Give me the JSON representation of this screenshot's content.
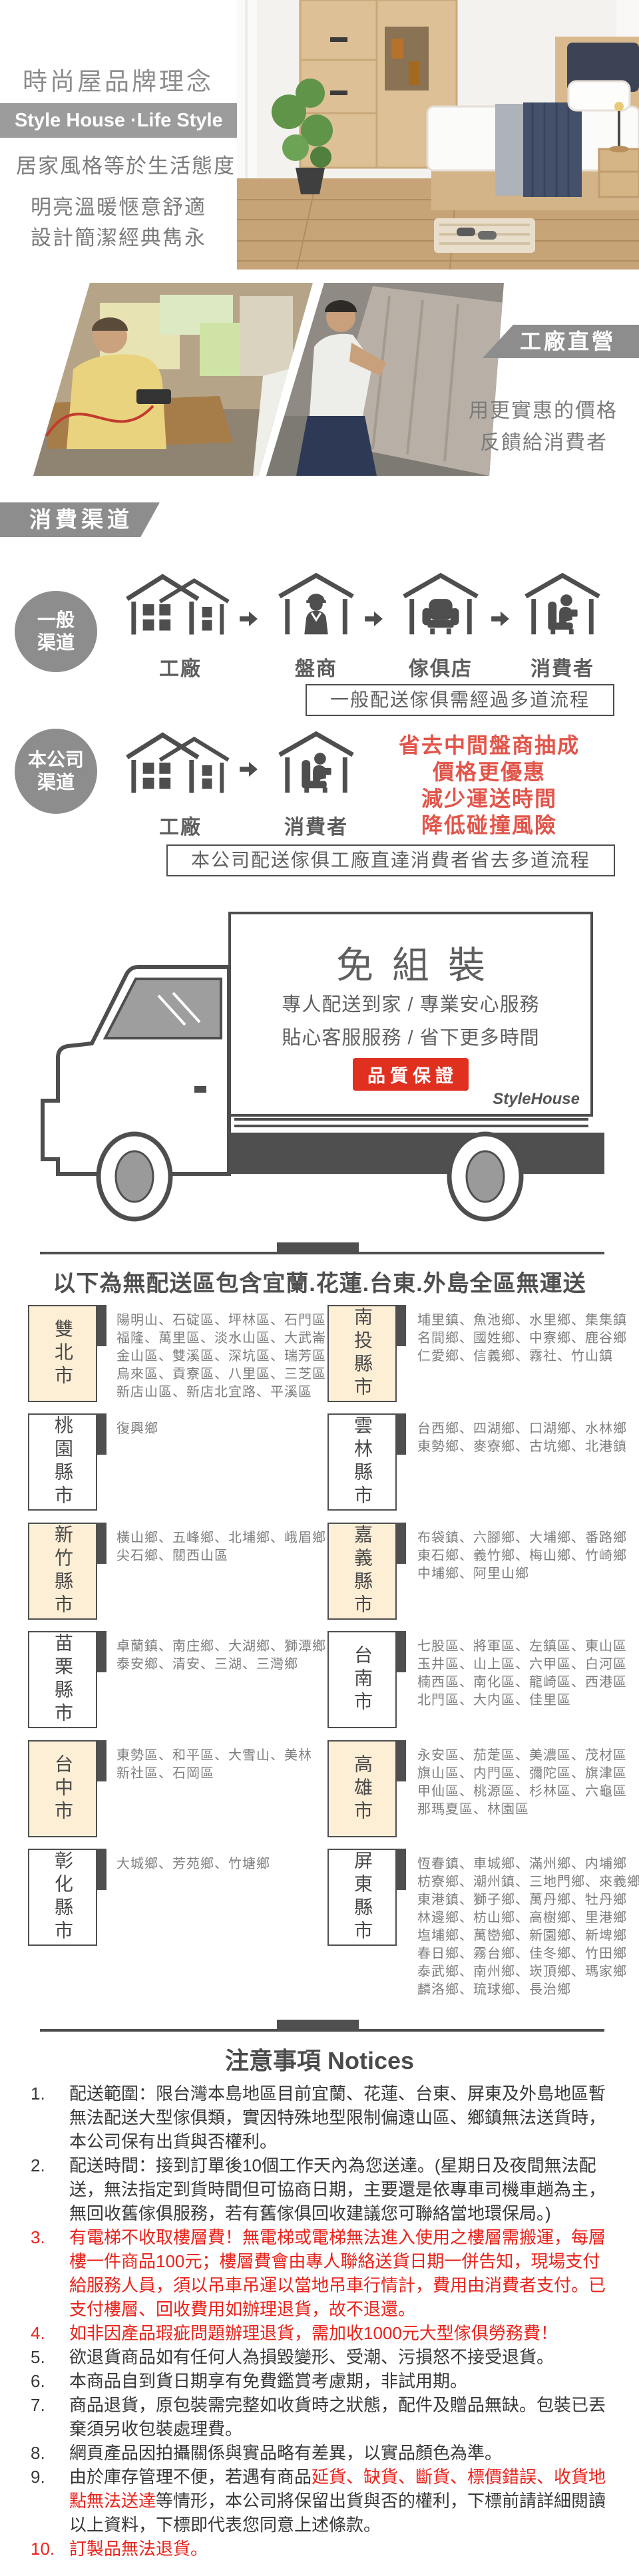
{
  "colors": {
    "banner_gray": "#9c9c9c",
    "mid_gray": "#8d8d8d",
    "outline": "#4e4e4e",
    "beige": "#fdeed6",
    "benefit_red": "#e2554a",
    "notice_red": "#e8231b",
    "badge_red": "#e03020"
  },
  "brand": {
    "title": "時尚屋品牌理念",
    "banner": "Style House ·Life Style",
    "lines": [
      "居家風格等於生活態度",
      "明亮溫暖愜意舒適",
      "設計簡潔經典雋永"
    ]
  },
  "factory": {
    "banner": "工廠直營",
    "lines": [
      "用更實惠的價格",
      "反饋給消費者"
    ]
  },
  "channels": {
    "banner": "消費渠道",
    "general": {
      "badge_lines": [
        "一般",
        "渠道"
      ],
      "steps": [
        "工廠",
        "盤商",
        "傢俱店",
        "消費者"
      ],
      "note": "一般配送傢俱需經過多道流程"
    },
    "company": {
      "badge_lines": [
        "本公司",
        "渠道"
      ],
      "steps": [
        "工廠",
        "消費者"
      ],
      "benefits": [
        "省去中間盤商抽成",
        "價格更優惠",
        "減少運送時間",
        "降低碰撞風險"
      ],
      "note": "本公司配送傢俱工廠直達消費者省去多道流程"
    }
  },
  "truck": {
    "headline": "免組裝",
    "lines": [
      "專人配送到家 / 專業安心服務",
      "貼心客服服務 / 省下更多時間"
    ],
    "badge": "品質保證",
    "brand": "StyleHouse"
  },
  "no_delivery": {
    "title": "以下為無配送區包含宜蘭.花蓮.台東.外島全區無運送",
    "rows": [
      {
        "left": {
          "name": "雙北市",
          "beige": true,
          "lines": [
            "陽明山、石碇區、坪林區、石門區",
            "福隆、萬里區、淡水山區、大武崙",
            "金山區、雙溪區、深坑區、瑞芳區",
            "烏來區、貢寮區、八里區、三芝區",
            "新店山區、新店北宜路、平溪區"
          ]
        },
        "right": {
          "name": "南投縣市",
          "beige": true,
          "lines": [
            "埔里鎮、魚池鄉、水里鄉、集集鎮",
            "名間鄉、國姓鄉、中寮鄉、鹿谷鄉",
            "仁愛鄉、信義鄉、霧社、竹山鎮"
          ]
        }
      },
      {
        "left": {
          "name": "桃園縣市",
          "beige": false,
          "lines": [
            "復興鄉"
          ]
        },
        "right": {
          "name": "雲林縣市",
          "beige": false,
          "lines": [
            "台西鄉、四湖鄉、口湖鄉、水林鄉",
            "東勢鄉、麥寮鄉、古坑鄉、北港鎮"
          ]
        }
      },
      {
        "left": {
          "name": "新竹縣市",
          "beige": true,
          "lines": [
            "橫山鄉、五峰鄉、北埔鄉、峨眉鄉",
            "尖石鄉、關西山區"
          ]
        },
        "right": {
          "name": "嘉義縣市",
          "beige": true,
          "lines": [
            "布袋鎮、六腳鄉、大埔鄉、番路鄉",
            "東石鄉、義竹鄉、梅山鄉、竹崎鄉",
            "中埔鄉、阿里山鄉"
          ]
        }
      },
      {
        "left": {
          "name": "苗栗縣市",
          "beige": false,
          "lines": [
            "卓蘭鎮、南庄鄉、大湖鄉、獅潭鄉",
            "泰安鄉、清安、三湖、三灣鄉"
          ]
        },
        "right": {
          "name": "台南市",
          "beige": false,
          "lines": [
            "七股區、將軍區、左鎮區、東山區",
            "玉井區、山上區、六甲區、白河區",
            "楠西區、南化區、龍崎區、西港區",
            "北門區、大内區、佳里區"
          ]
        }
      },
      {
        "left": {
          "name": "台中市",
          "beige": true,
          "lines": [
            "東勢區、和平區、大雪山、美林",
            "新社區、石岡區"
          ]
        },
        "right": {
          "name": "高雄市",
          "beige": true,
          "lines": [
            "永安區、茄萣區、美濃區、茂材區",
            "旗山區、内門區、彌陀區、旗津區",
            "甲仙區、桃源區、杉林區、六龜區",
            "那瑪夏區、林園區"
          ]
        }
      },
      {
        "left": {
          "name": "彰化縣市",
          "beige": false,
          "lines": [
            "大城鄉、芳苑鄉、竹塘鄉"
          ]
        },
        "right": {
          "name": "屏東縣市",
          "beige": false,
          "lines": [
            "恆春鎮、車城鄉、滿州鄉、内埔鄉",
            "枋寮鄉、潮州鎮、三地門鄉、來義鄉",
            "東港鎮、獅子鄉、萬丹鄉、牡丹鄉",
            "林邊鄉、枋山鄉、高樹鄉、里港鄉",
            "塩埔鄉、萬巒鄉、新園鄉、新埤鄉",
            "春日鄉、霧台鄉、佳冬鄉、竹田鄉",
            "泰武鄉、南州鄉、崁頂鄉、瑪家鄉",
            "麟洛鄉、琉球鄉、長治鄉"
          ]
        }
      }
    ]
  },
  "notices": {
    "title": "注意事項 Notices",
    "items": [
      {
        "num": "1.",
        "parts": [
          {
            "text": "配送範圍：限台灣本島地區目前宜蘭、花蓮、台東、屏東及外島地區暫無法配送大型傢俱類，實因特殊地型限制偏遠山區、鄉鎮無法送貨時，本公司保有出貨與否權利。",
            "red": false
          }
        ]
      },
      {
        "num": "2.",
        "parts": [
          {
            "text": "配送時間：接到訂單後10個工作天內為您送達。(星期日及夜間無法配送，無法指定到貨時間但可協商日期，主要還是依專車司機車趟為主，無回收舊傢俱服務，若有舊傢俱回收建議您可聯絡當地環保局。)",
            "red": false
          }
        ]
      },
      {
        "num": "3.",
        "parts": [
          {
            "text": "有電梯不收取樓層費！無電梯或電梯無法進入使用之樓層需搬運，每層樓一件商品100元；樓層費會由專人聯絡送貨日期一併告知，現場支付給服務人員，須以吊車吊運以當地吊車行情計，費用由消費者支付。已支付樓層、回收費用如辦理退貨，故不退還。",
            "red": true
          }
        ]
      },
      {
        "num": "4.",
        "parts": [
          {
            "text": "如非因產品瑕疵問題辦理退貨，需加收1000元大型傢俱勞務費！",
            "red": true
          }
        ]
      },
      {
        "num": "5.",
        "parts": [
          {
            "text": "欲退貨商品如有任何人為損毀變形、受潮、污損怒不接受退貨。",
            "red": false
          }
        ]
      },
      {
        "num": "6.",
        "parts": [
          {
            "text": "本商品自到貨日期享有免費鑑賞考慮期，非試用期。",
            "red": false
          }
        ]
      },
      {
        "num": "7.",
        "parts": [
          {
            "text": "商品退貨，原包裝需完整如收貨時之狀態，配件及贈品無缺。包裝已丟棄須另收包裝處理費。",
            "red": false
          }
        ]
      },
      {
        "num": "8.",
        "parts": [
          {
            "text": "網頁產品因拍攝關係與實品略有差異，以實品顏色為準。",
            "red": false
          }
        ]
      },
      {
        "num": "9.",
        "parts": [
          {
            "text": "由於庫存管理不便，若遇有商品",
            "red": false
          },
          {
            "text": "延貨、缺貨、斷貨、標價錯誤、收貨地點無法送達",
            "red": true
          },
          {
            "text": "等情形，本公司將保留出貨與否的權利，下標前請詳細閱讀以上資料，下標即代表您同意上述條款。",
            "red": false
          }
        ]
      },
      {
        "num": "10.",
        "parts": [
          {
            "text": "訂製品無法退貨。",
            "red": true
          }
        ]
      }
    ]
  }
}
